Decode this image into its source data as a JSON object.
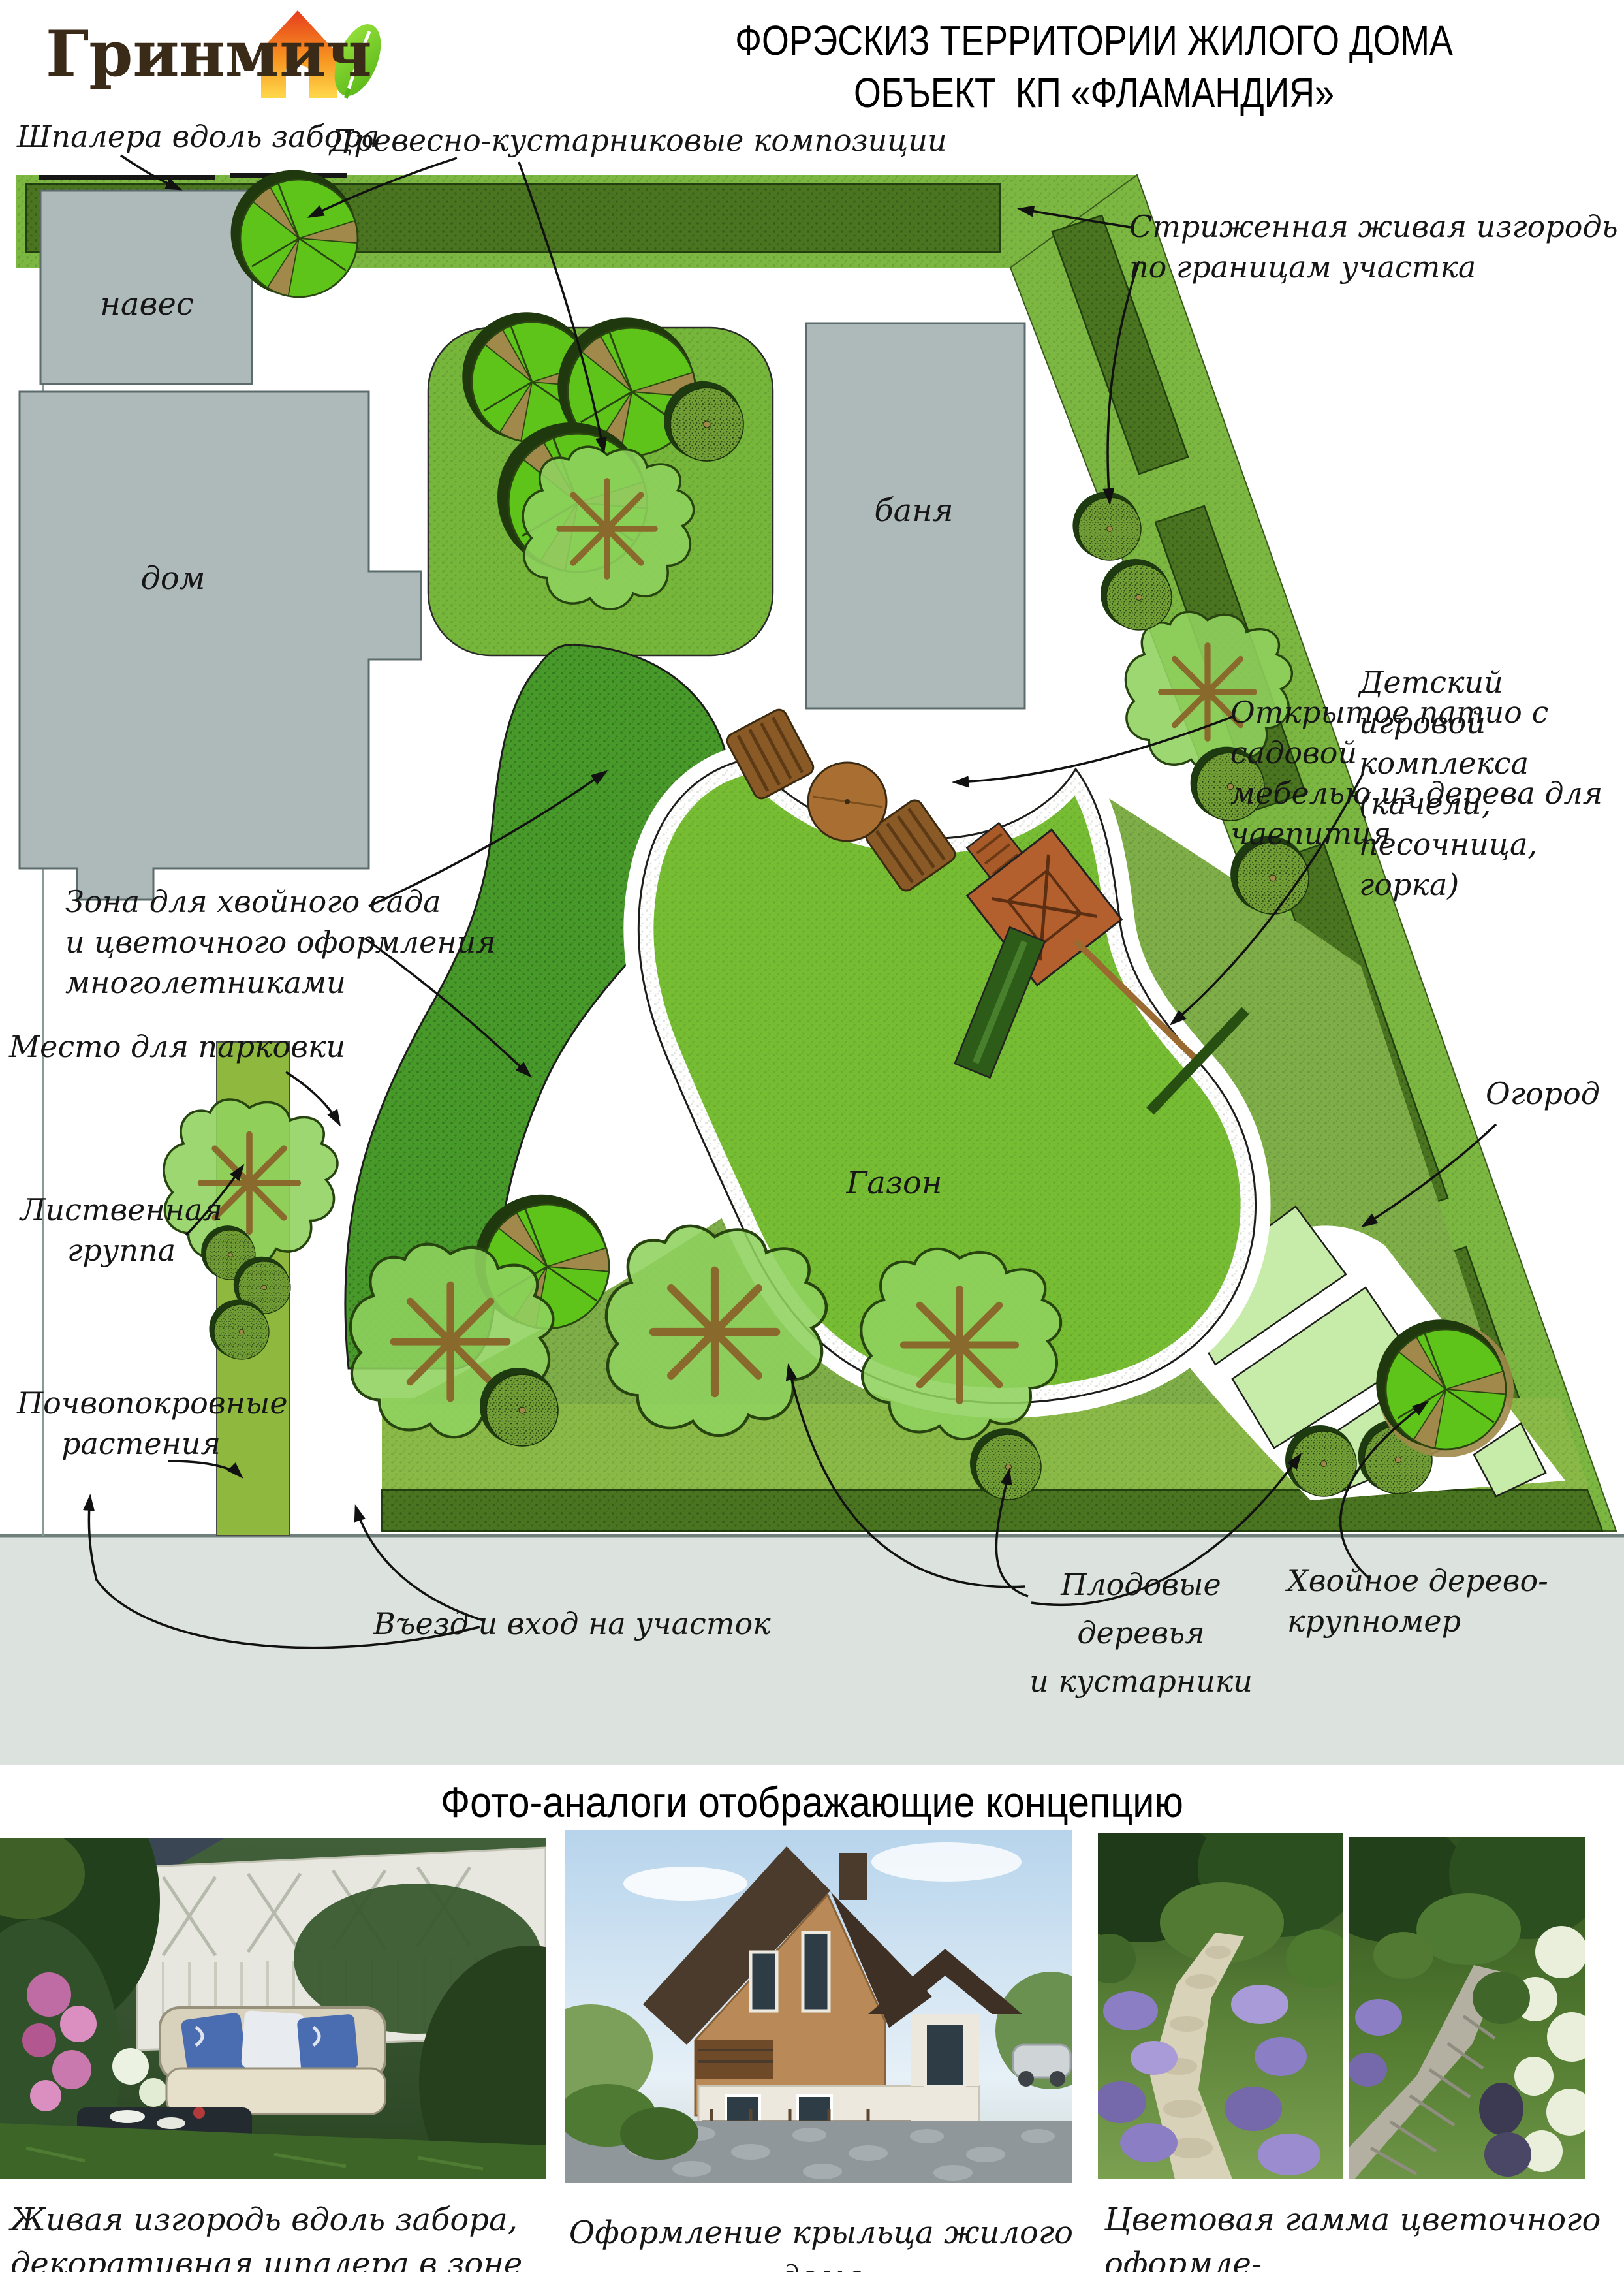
{
  "header": {
    "logo_text": "Гринмич",
    "title_line1": "ФОРЭСКИЗ ТЕРРИТОРИИ ЖИЛОГО ДОМА",
    "title_line2": "ОБЪЕКТ  КП «ФЛАМАНДИЯ»"
  },
  "plan": {
    "areas": {
      "canopy": "навес",
      "house": "дом",
      "bathhouse": "баня",
      "lawn": "Газон"
    },
    "annotations": {
      "trellis": "Шпалера вдоль забора",
      "compositions": "Древесно-кустарниковые композиции",
      "hedge": "Стриженная живая изгородь\nпо границам участка",
      "patio": "Открытое патио с садовой\nмебелью из дерева для чаепития",
      "playground": "Детский игровой\nкомплекса (качели,\nпесочница, горка)",
      "conifer_zone": "Зона для хвойного сада\nи цветочного оформления\nмноголетниками",
      "parking": "Место для парковки",
      "deciduous_group": "Лиственная\nгруппа",
      "groundcover": "Почвопокровные\nрастения",
      "entrance": "Въезд и вход на участок",
      "fruit_trees": "Плодовые деревья\nи кустарники",
      "large_conifer": "Хвойное дерево-крупномер",
      "vegetable_garden": "Огород"
    }
  },
  "photos": {
    "section_title": "Фото-аналоги отображающие концепцию",
    "captions": [
      "Живая изгородь вдоль забора,\nдекоративная шпалера в зоне навеса",
      "Оформление крыльца жилого дома",
      "Цветовая гамма цветочного оформле-\nния мощеных площадок и дорожек в саду"
    ]
  },
  "colors": {
    "lawn_green": "#77bd33",
    "conifer_zone_green": "#47992a",
    "hedge_dark_green": "#4a7420",
    "band_light_green": "#7cb742",
    "garden_bed_pale": "#c7eba9",
    "building_gray": "#aeb9b9",
    "road_gray": "#dce2de",
    "wood_brown": "#a96f32",
    "logo_brown": "#3a2a18",
    "logo_leaf_green": "#6fc62d",
    "logo_house_orange": "#f26a22"
  },
  "icons": {
    "logo_house_icon": "house-with-leaf",
    "leader_arrow": "black-curved-arrow"
  }
}
